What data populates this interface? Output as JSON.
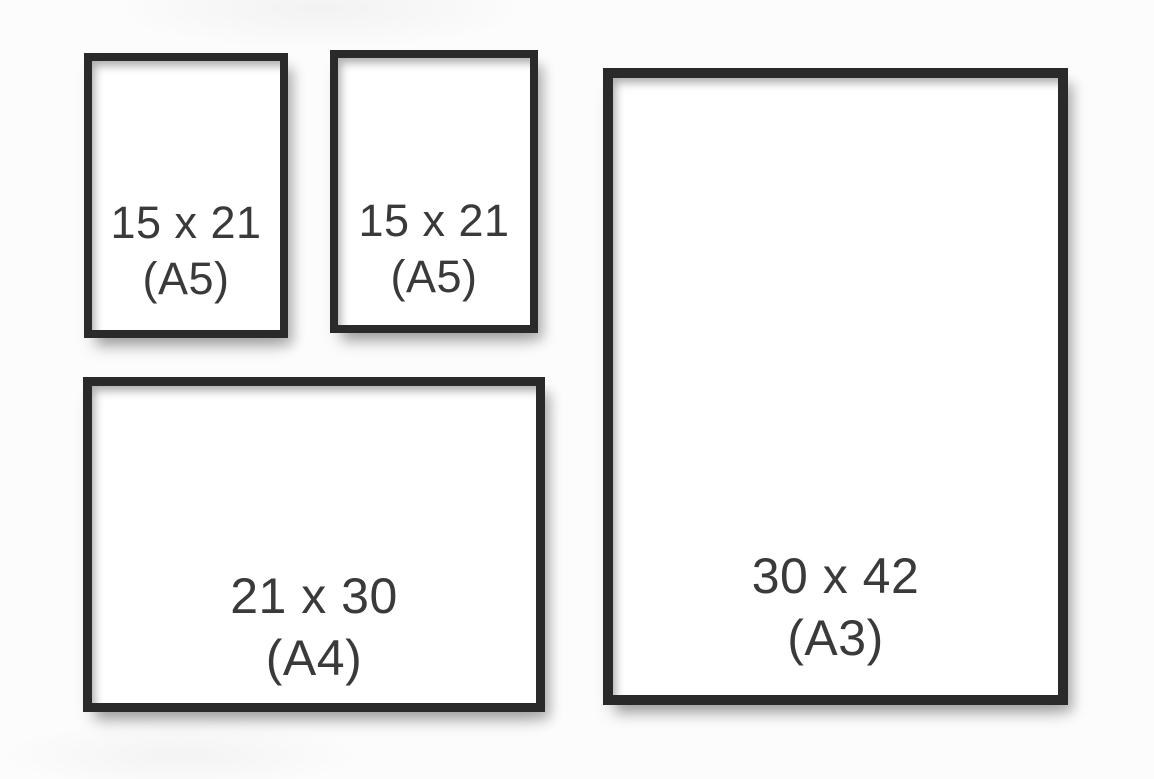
{
  "diagram": {
    "title": "picture-frame-size-comparison"
  },
  "colors": {
    "background": "#fcfcfc",
    "frame_border": "#2a2a2a",
    "frame_fill": "#ffffff",
    "label_text": "#3a3a3a"
  },
  "frames": [
    {
      "id": "a5-left",
      "orientation": "portrait",
      "size_label": "15 x 21",
      "format_label": "(A5)"
    },
    {
      "id": "a5-middle",
      "orientation": "portrait",
      "size_label": "15 x 21",
      "format_label": "(A5)"
    },
    {
      "id": "a4",
      "orientation": "landscape",
      "size_label": "21 x 30",
      "format_label": "(A4)"
    },
    {
      "id": "a3",
      "orientation": "portrait",
      "size_label": "30 x 42",
      "format_label": "(A3)"
    }
  ]
}
